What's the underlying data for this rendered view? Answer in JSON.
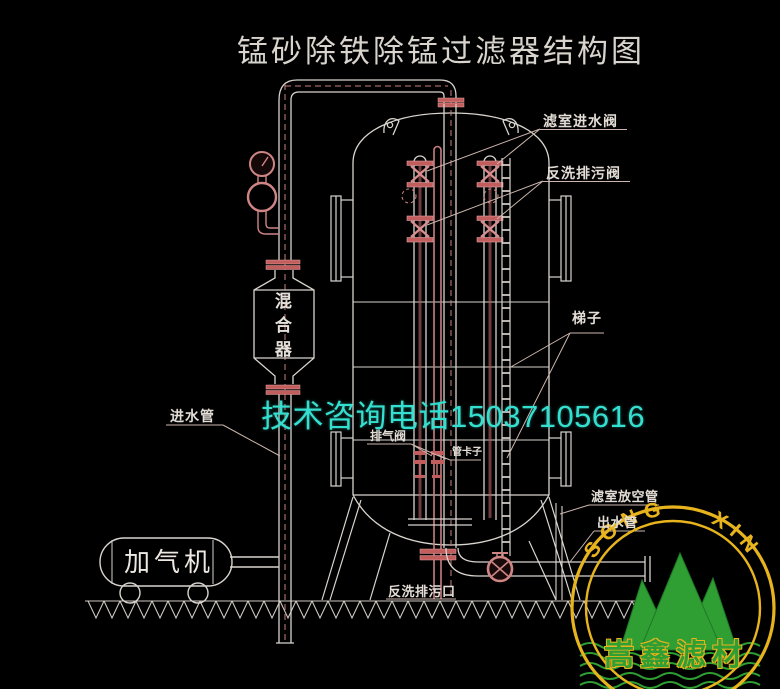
{
  "title": "锰砂除铁除锰过滤器结构图",
  "watermark": "技术咨询电话15037105616",
  "diagram": {
    "labels": {
      "filter_inlet_valve": "滤室进水阀",
      "backwash_drain_valve": "反洗排污阀",
      "ladder": "梯子",
      "vent_pipe": "滤室放空管",
      "outlet_pipe": "出水管",
      "inlet_pipe": "进水管",
      "air_release_valve": "排气阀",
      "pipe_clamp": "管卡子",
      "backwash_drain_outlet": "反洗排污口",
      "mixer_vessel": "混合器",
      "aerator_machine": "加气机"
    }
  },
  "logo": {
    "arc_text": "SONG XIN",
    "brand_name": "嵩鑫滤材",
    "ring_color": "#e8b41e",
    "mountain_color": "#2f9e33",
    "brand_text_color": "#2f9e33"
  },
  "colors": {
    "background": "#000000",
    "line_white": "#d9d4ce",
    "pipe_pink": "#c97f7f",
    "watermark_cyan": "#35dfcf"
  }
}
